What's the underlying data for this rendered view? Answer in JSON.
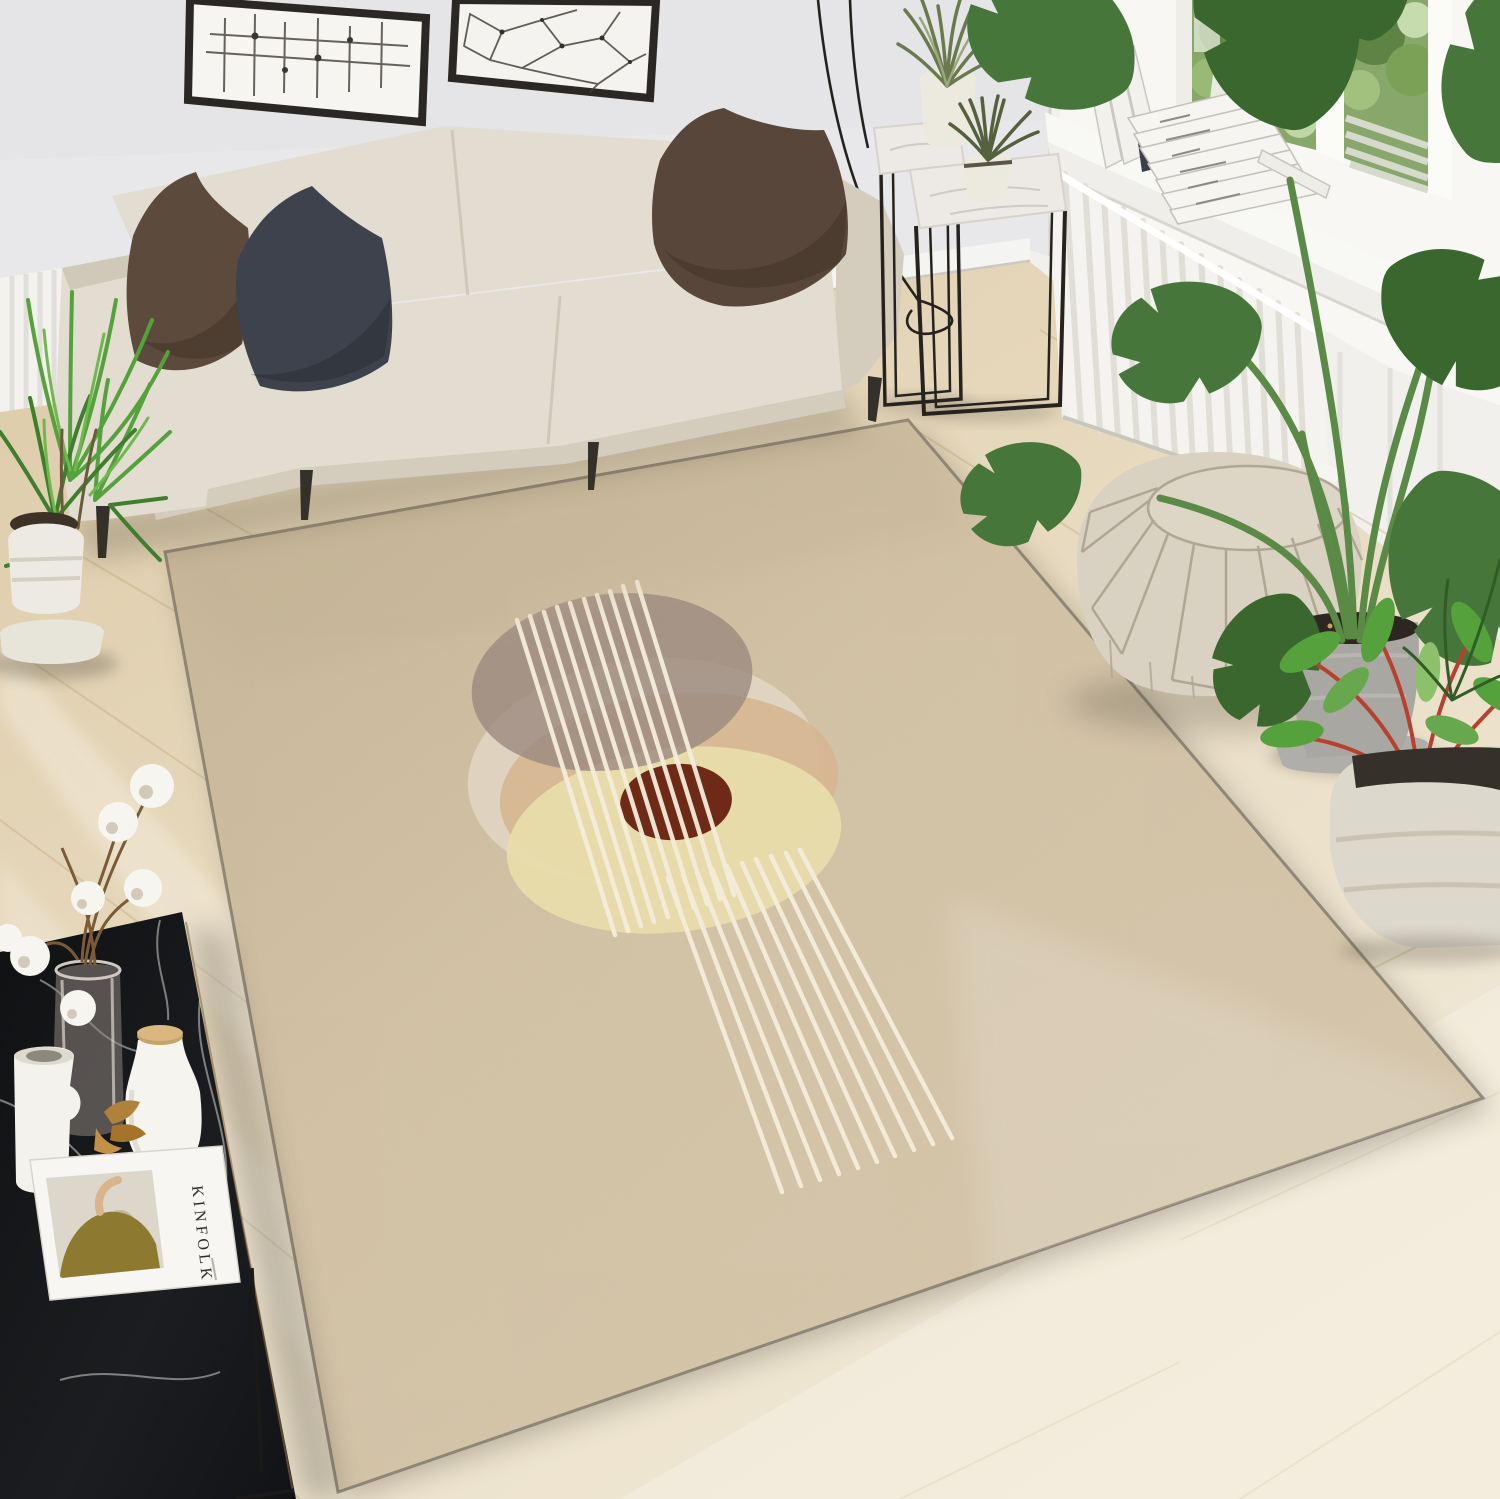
{
  "meta": {
    "title": "Bright living room product photo of a beige abstract area rug"
  },
  "magazine": {
    "title": "KINFOLK"
  },
  "books": {
    "spine_fragment": "Wro"
  },
  "rug": {
    "type": "rectangular low-pile area rug",
    "circles": 5,
    "white_lines_top_group": 10,
    "white_lines_bottom_group": 10
  },
  "counts": {
    "wall_frames": 2,
    "throw_pillows": 3,
    "plant_stands": 2,
    "potted_plants": 5
  },
  "palette": {
    "wallFront": "#e8e7e9",
    "wallRight": "#f1f0ec",
    "windowWhite": "#f8f7f4",
    "paneGreen": "#87a86a",
    "rugField": "#d2c2a6",
    "rugEdge": "#7a7164",
    "circleTaupe": "#9b8a7e",
    "circlePale": "#f0e8de",
    "circleTan": "#d7b691",
    "circleCream": "#e9dcab",
    "circleMaroon": "#6e2a17",
    "lineCream": "#f4ecda",
    "sofa": "#e3ddd1",
    "sofaShade": "#d4cdbd",
    "pillowBrown": "#5c4a3c",
    "pillowCharcoal": "#3e424c",
    "pillowBrown2": "#58463a",
    "legDark": "#34302a",
    "marble": "#edeae6",
    "metal": "#26231f",
    "radiator": "#f4f3ef",
    "pouf": "#d9d1c1",
    "poufSeam": "#b0a693",
    "tableBlack": "#17181b",
    "potWhite": "#eceade",
    "potConcrete": "#a9a7a2",
    "monstera": "#47763a",
    "monsteraDark": "#3a672e",
    "palmGreen": "#55a23c",
    "grassOlive": "#6b7a4e",
    "cotton": "#f7f5f0",
    "cork": "#c8a26a",
    "driedLeaf": "#b0813a",
    "magazineWhite": "#f7f6f2",
    "sweaterOlive": "#8d7a30",
    "bookDark": "#3a3f49"
  }
}
